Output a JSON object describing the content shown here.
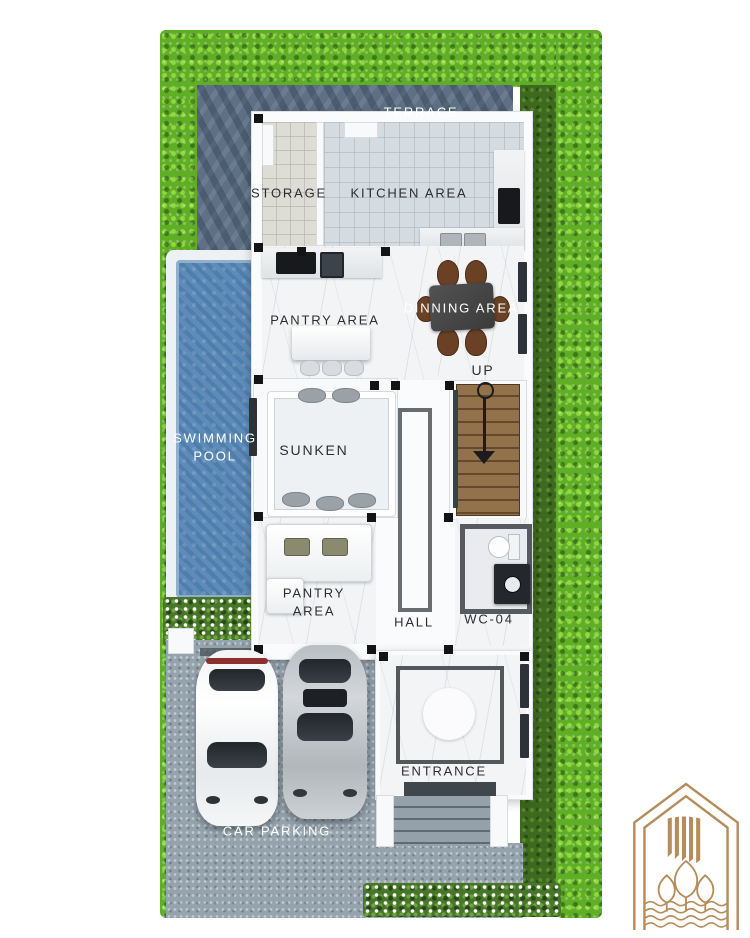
{
  "title": "3D house floor plan rendering",
  "labels": {
    "terrace": "TERRACE",
    "storage": "STORAGE",
    "kitchen": "KITCHEN AREA",
    "pantry_upper": "PANTRY AREA",
    "dining": "DINNING AREA",
    "up": "UP",
    "pool_line1": "SWIMMING",
    "pool_line2": "POOL",
    "sunken": "SUNKEN",
    "pantry_lower_line1": "PANTRY",
    "pantry_lower_line2": "AREA",
    "hall": "HALL",
    "wc": "WC-04",
    "entrance": "ENTRANCE",
    "parking": "CAR PARKING"
  },
  "colors": {
    "hedge_green": "#5fae26",
    "grass_green": "#3e6a20",
    "terrace_stone": "#5e7084",
    "pool_blue": "#5d8cba",
    "marble_floor": "#f3f4f6",
    "stair_wood": "#8a6a43",
    "dining_chair_brown": "#6a4124",
    "concrete_gray": "#95a3ad",
    "logo_gold": "#b68c5a"
  },
  "icons": {
    "up_arrow": "stair direction arrow pointing down-plan (UP)",
    "logo": "gold house-with-trees brand emblem"
  }
}
